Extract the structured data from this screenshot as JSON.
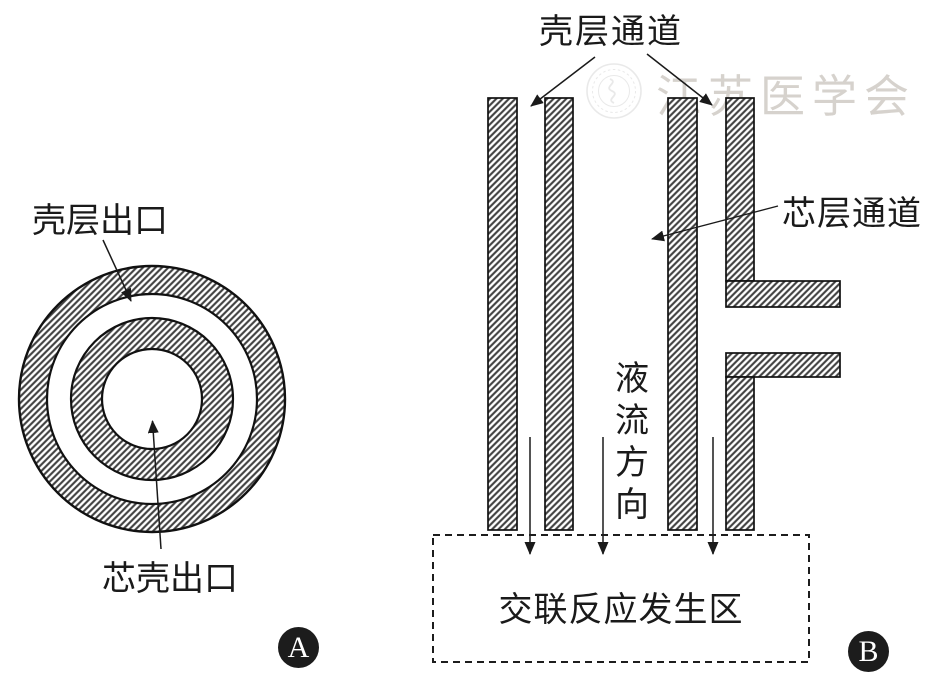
{
  "figure": {
    "watermark": {
      "seal_icon": "medical-association-seal",
      "text": "江苏医学会"
    },
    "panel_a": {
      "badge_label": "A",
      "shell_outlet_label": "壳层出口",
      "core_shell_outlet_label": "芯壳出口"
    },
    "panel_b": {
      "badge_label": "B",
      "shell_channel_label": "壳层通道",
      "core_channel_label": "芯层通道",
      "flow_direction_label": "液流方向",
      "reaction_zone_label": "交联反应发生区"
    },
    "colors": {
      "ink": "#1a1a1a",
      "hatch_line": "#3f3f3f",
      "outline": "#111111",
      "badge_background": "#1c1c1c",
      "watermark_gray": "#c9c4bd"
    }
  }
}
